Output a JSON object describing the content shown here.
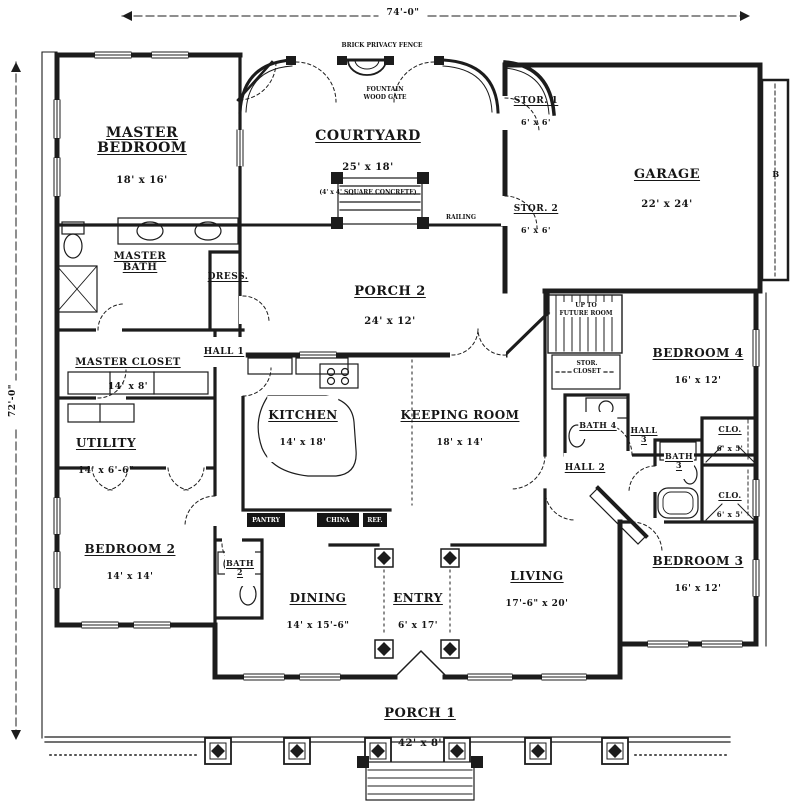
{
  "plan_title": "Single-story house floor plan",
  "dimensions": {
    "top": "74'-0\"",
    "left": "72'-0\""
  },
  "rooms": {
    "master_bedroom": {
      "name": "MASTER\nBEDROOM",
      "dims": "18' x 16'"
    },
    "courtyard": {
      "name": "COURTYARD",
      "dims": "25' x 18'"
    },
    "garage": {
      "name": "GARAGE",
      "dims": "22' x 24'"
    },
    "stor_1": {
      "name": "STOR. 1",
      "dims": "6' x 6'"
    },
    "stor_2": {
      "name": "STOR. 2",
      "dims": "6' x 6'"
    },
    "master_bath": {
      "name": "MASTER\nBATH"
    },
    "dress": {
      "name": "DRESS."
    },
    "porch_2": {
      "name": "PORCH 2",
      "dims": "24' x 12'"
    },
    "master_closet": {
      "name": "MASTER CLOSET",
      "dims": "14' x 8'"
    },
    "hall_1": {
      "name": "HALL 1"
    },
    "utility": {
      "name": "UTILITY",
      "dims": "14' x 6'-6\""
    },
    "kitchen": {
      "name": "KITCHEN",
      "dims": "14' x 18'"
    },
    "keeping_room": {
      "name": "KEEPING ROOM",
      "dims": "18' x 14'"
    },
    "bedroom_4": {
      "name": "BEDROOM 4",
      "dims": "16' x 12'"
    },
    "bath_4": {
      "name": "BATH 4"
    },
    "hall_3": {
      "name": "HALL\n3"
    },
    "bath_3": {
      "name": "BATH\n3"
    },
    "clo_1": {
      "name": "CLO.",
      "dims": "6' x 5'"
    },
    "clo_2": {
      "name": "CLO.",
      "dims": "6' x 5'"
    },
    "hall_2": {
      "name": "HALL 2"
    },
    "bedroom_2": {
      "name": "BEDROOM 2",
      "dims": "14' x 14'"
    },
    "bath_2": {
      "name": "BATH\n2"
    },
    "dining": {
      "name": "DINING",
      "dims": "14' x 15'-6\""
    },
    "entry": {
      "name": "ENTRY",
      "dims": "6' x 17'"
    },
    "living": {
      "name": "LIVING",
      "dims": "17'-6\" x 20'"
    },
    "bedroom_3": {
      "name": "BEDROOM 3",
      "dims": "16' x 12'"
    },
    "porch_1": {
      "name": "PORCH 1",
      "dims": "42' x 8'"
    }
  },
  "notes": {
    "fence": "BRICK PRIVACY FENCE",
    "fountain_gate": "FOUNTAIN\nWOOD GATE",
    "railing": "RAILING",
    "courtyard_note": "(4' x 4' SQUARE CONCRETE)",
    "up_to": "UP TO\nFUTURE ROOM",
    "stor_closet": "STOR.\nCLOSET",
    "garage_marker": "B"
  },
  "fixtures": {
    "pantry": "PANTRY",
    "china": "CHINA",
    "ref": "REF."
  },
  "colors": {
    "ink": "#1c1c1c",
    "paper": "#ffffff"
  }
}
